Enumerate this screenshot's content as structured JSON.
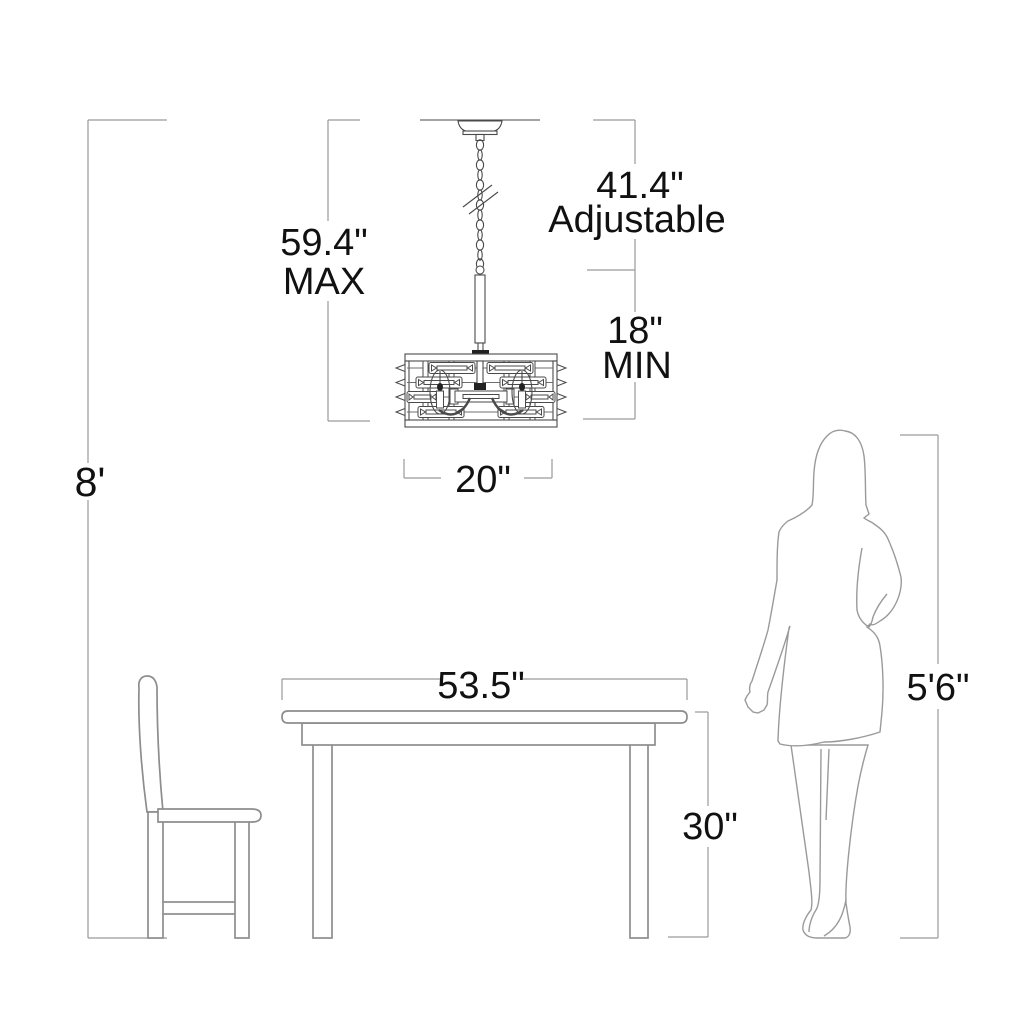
{
  "page": {
    "title": "Chandelier Dining Room Dimension Diagram",
    "background": "#ffffff"
  },
  "labels": {
    "ceiling_height": "8'",
    "max_height": "59.4\"",
    "max_qualifier": "MAX",
    "adjustable_height": "41.4\"",
    "adjustable_qualifier": "Adjustable",
    "min_height": "18\"",
    "min_qualifier": "MIN",
    "fixture_width": "20\"",
    "table_width": "53.5\"",
    "table_height": "30\"",
    "person_height": "5'6\""
  },
  "colors": {
    "dimension_line": "#9a9a9a",
    "furniture_line": "#8d8d8d",
    "person_line": "#9a9a9a",
    "fixture_line": "#4a4a4a",
    "text": "#111111",
    "background": "#ffffff"
  }
}
